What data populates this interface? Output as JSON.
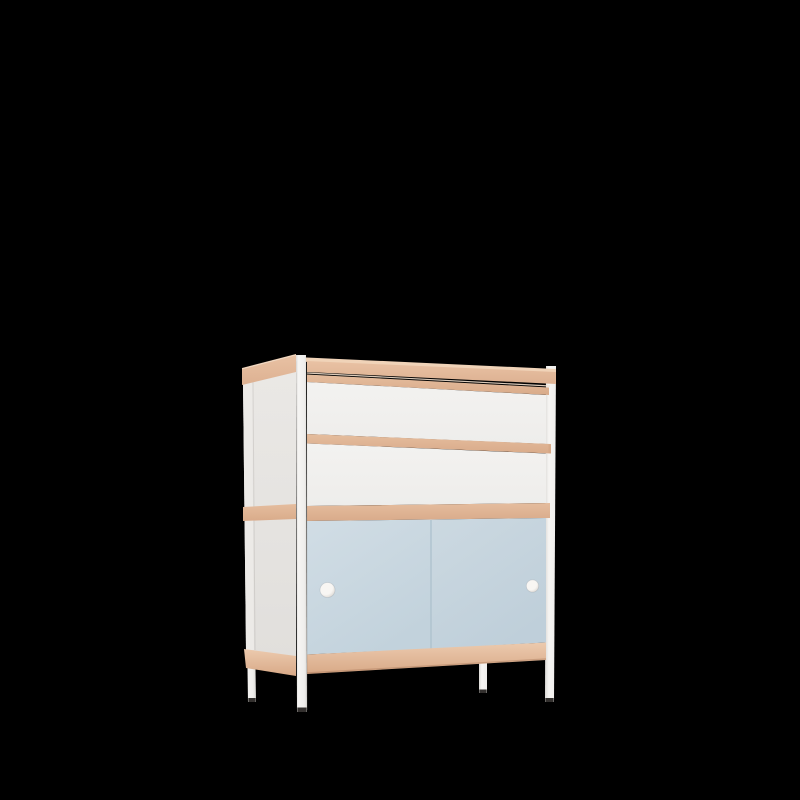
{
  "scene": {
    "description": "3D product render of a childrens cabinet with two white drawers, a wooden frame and two light-blue sliding doors with round handles, standing on four slim white legs, on a plain black background",
    "object_name": "kids-cabinet",
    "background_color": "#000000"
  },
  "colors": {
    "background": "#000000",
    "wood_top_surface": "#f0d3b8",
    "wood_band_light": "#e9c2a4",
    "wood_band_dark": "#ddb192",
    "wood_rail_light": "#e5bd9e",
    "wood_rail_dark": "#d9ab8a",
    "wood_bottom_light": "#eccaae",
    "wood_bottom_dark": "#d8a987",
    "wood_seam_highlight": "#f3e2d0",
    "front_white_light": "#f3f2f0",
    "front_white_dark": "#eeedeb",
    "side_white_light": "#eae8e5",
    "side_white_dark": "#e1dfdc",
    "side_post_highlight": "#eceae7",
    "post_light": "#f6f5f3",
    "post_mid": "#efeeec",
    "post_dark": "#dddbd8",
    "door_left_light": "#d1dde5",
    "door_left_dark": "#c2d2dc",
    "door_right_light": "#ccd9e1",
    "door_right_dark": "#bfcfda",
    "door_seam": "#aec2ce",
    "handle_light": "#f8f6f3",
    "handle_dark": "#d9d5cf",
    "foot_cap": "#33302e"
  },
  "parts": {
    "top_surface": "wooden top panel",
    "top_rail": "wooden top front rail",
    "upper_rail": "wooden rail above top drawer",
    "drawer_upper": "upper white drawer front",
    "drawer_divider_rail": "wooden rail between drawers",
    "drawer_lower": "lower white drawer front",
    "shelf_rail": "wooden shelf rail above doors",
    "sliding_door_left": "light blue sliding door (left)",
    "sliding_door_right": "light blue sliding door (right)",
    "handle_left": "round white handle (left door)",
    "handle_right": "round white handle (right door)",
    "bottom_rail": "wooden bottom rail",
    "side_panel": "white left side panel",
    "side_top_rail": "wooden top rail of side panel",
    "side_shelf_rail": "wooden shelf rail of side panel",
    "side_bottom_rail": "wooden bottom rail of side panel",
    "leg_front_left": "white front-left leg",
    "leg_front_right": "white front-right leg",
    "leg_rear_left": "white rear-left leg",
    "leg_rear_right": "white rear-right leg"
  }
}
